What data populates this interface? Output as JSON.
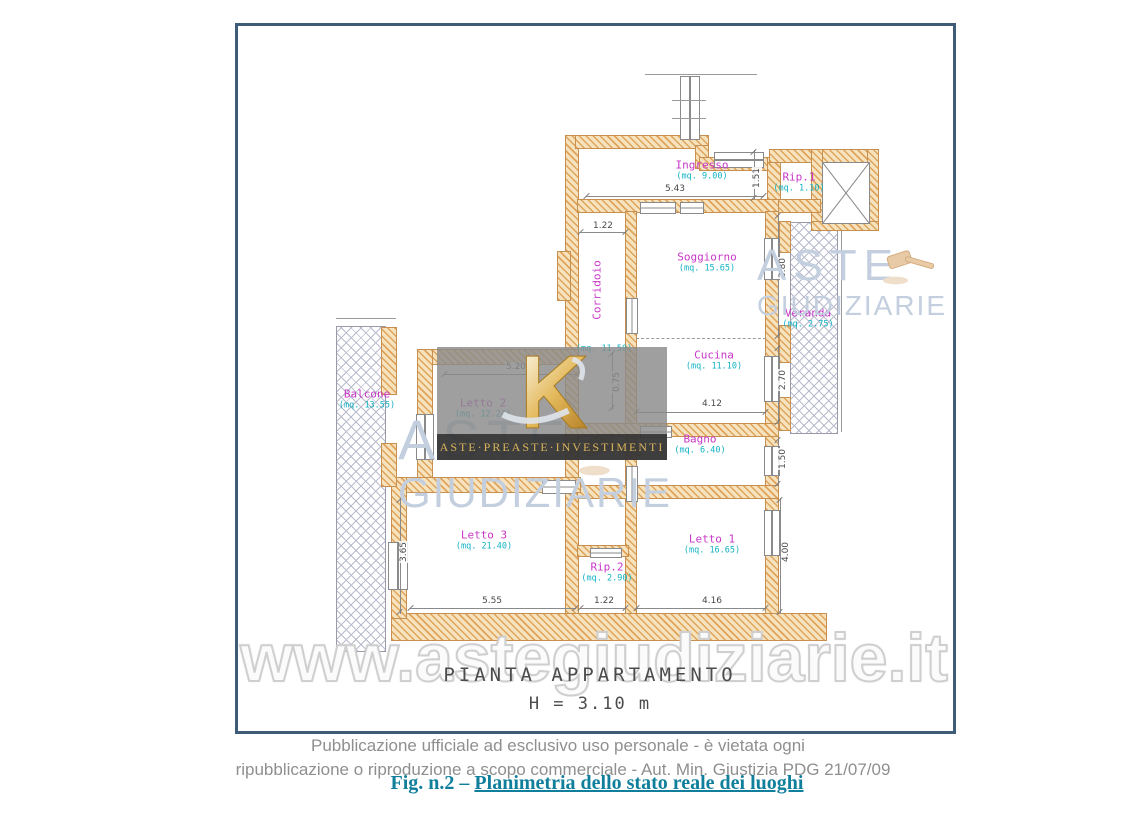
{
  "plan": {
    "title": "PIANTA APPARTAMENTO",
    "height_label": "H = 3.10 m",
    "rooms": [
      {
        "name": "Ingresso",
        "area": "(mq. 9.00)"
      },
      {
        "name": "Rip.1",
        "area": "(mq. 1.10)"
      },
      {
        "name": "Soggiorno",
        "area": "(mq. 15.65)"
      },
      {
        "name": "Cucina",
        "area": "(mq. 11.10)"
      },
      {
        "name": "Veranda",
        "area": "(mq. 2.75)"
      },
      {
        "name": "Bagno",
        "area": "(mq. 6.40)"
      },
      {
        "name": "Letto 1",
        "area": "(mq. 16.65)"
      },
      {
        "name": "Rip.2",
        "area": "(mq. 2.90)"
      },
      {
        "name": "Letto 3",
        "area": "(mq. 21.40)"
      },
      {
        "name": "Letto 2",
        "area": "(mq. 12.24)"
      },
      {
        "name": "Corridoio",
        "area": "(mq. 11.50)"
      },
      {
        "name": "Balcone",
        "area": "(mq. 13.55)"
      }
    ],
    "dims": [
      {
        "value": "5.43"
      },
      {
        "value": "1.51"
      },
      {
        "value": "1.22"
      },
      {
        "value": "3.80"
      },
      {
        "value": "2.70"
      },
      {
        "value": "4.12"
      },
      {
        "value": "1.50"
      },
      {
        "value": "4.00"
      },
      {
        "value": "4.16"
      },
      {
        "value": "1.22"
      },
      {
        "value": "5.55"
      },
      {
        "value": "3.65"
      },
      {
        "value": "5.20"
      },
      {
        "value": "0.75"
      }
    ]
  },
  "watermarks": {
    "brand_top": "ASTE",
    "brand_bottom": "GIUDIZIARIE",
    "banner": "ASTE·PREASTE·INVESTIMENTI",
    "site": "www.astegiudiziarie.it"
  },
  "footer": {
    "line1": "Pubblicazione ufficiale ad esclusivo uso personale - è vietata ogni",
    "line2": "ripubblicazione o riproduzione a scopo commerciale - Aut. Min. Giustizia PDG 21/07/09",
    "fig_prefix": "Fig. n.2 – ",
    "fig_link": "Planimetria dello stato reale dei luoghi"
  },
  "colors": {
    "frame_border": "#3e5c77",
    "wall_fill": "#f6e2bd",
    "wall_hatch": "#dfa45c",
    "room_name": "#c837c8",
    "room_area": "#12b2c4",
    "balcony_hatch": "#b9bccc",
    "watermark_brand": "#c3cfdf",
    "logo_gold": "#d9b35c",
    "caption_teal": "#0f7f9c",
    "footer_gray": "#8f8f8f"
  }
}
